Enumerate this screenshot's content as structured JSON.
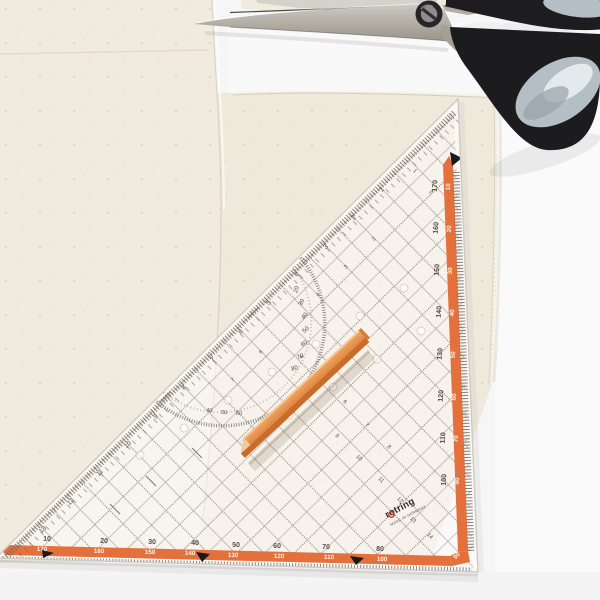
{
  "scene": {
    "description": "Flat-lay photo: transparent triangular tailor's ruler with orange scales on cream fabric, orange tailor's chalk stick on top, black scissors at top right"
  },
  "colors": {
    "accent_orange": "#e4713c",
    "stick_orange": "#e08a44",
    "handle_black": "#1c1c1e",
    "handle_grey_blue": "#b4bec5",
    "fabric_cream": "#efe9dc",
    "metal_grey": "#b2ada3",
    "print_grey": "#4f4942"
  },
  "ruler": {
    "brand": "rotring",
    "origin_text": "MADE IN GERMANY",
    "labels": [
      {
        "t": "10",
        "x": 47,
        "y": 541,
        "r": 1.5,
        "c": "n1"
      },
      {
        "t": "20",
        "x": 104,
        "y": 543,
        "r": 1.5,
        "c": "n1"
      },
      {
        "t": "30",
        "x": 152,
        "y": 544,
        "r": 1.5,
        "c": "n1"
      },
      {
        "t": "40",
        "x": 195,
        "y": 545,
        "r": 1.5,
        "c": "n1"
      },
      {
        "t": "50",
        "x": 236,
        "y": 547,
        "r": 1.5,
        "c": "n1"
      },
      {
        "t": "60",
        "x": 277,
        "y": 548,
        "r": 1.5,
        "c": "n1"
      },
      {
        "t": "70",
        "x": 326,
        "y": 549,
        "r": 1.5,
        "c": "n1"
      },
      {
        "t": "80",
        "x": 380,
        "y": 551,
        "r": 1.5,
        "c": "n1"
      },
      {
        "t": "170",
        "x": 42,
        "y": 551,
        "r": 1.5,
        "c": "n2"
      },
      {
        "t": "160",
        "x": 99,
        "y": 553,
        "r": 1.5,
        "c": "n2"
      },
      {
        "t": "150",
        "x": 150,
        "y": 554,
        "r": 1.5,
        "c": "n2"
      },
      {
        "t": "140",
        "x": 190,
        "y": 555,
        "r": 1.5,
        "c": "n2"
      },
      {
        "t": "130",
        "x": 233,
        "y": 557,
        "r": 1.5,
        "c": "n2"
      },
      {
        "t": "120",
        "x": 279,
        "y": 558,
        "r": 1.5,
        "c": "n2"
      },
      {
        "t": "110",
        "x": 329,
        "y": 559,
        "r": 1.5,
        "c": "n2"
      },
      {
        "t": "100",
        "x": 382,
        "y": 561,
        "r": 1.5,
        "c": "n2"
      },
      {
        "t": "90",
        "x": 458,
        "y": 557,
        "r": -45,
        "c": "n2"
      },
      {
        "t": "170",
        "x": 437,
        "y": 186,
        "r": -86,
        "c": "n1"
      },
      {
        "t": "160",
        "x": 438,
        "y": 228,
        "r": -86,
        "c": "n1"
      },
      {
        "t": "150",
        "x": 439,
        "y": 270,
        "r": -86,
        "c": "n1"
      },
      {
        "t": "140",
        "x": 441,
        "y": 312,
        "r": -86,
        "c": "n1"
      },
      {
        "t": "130",
        "x": 442,
        "y": 354,
        "r": -86,
        "c": "n1"
      },
      {
        "t": "120",
        "x": 443,
        "y": 396,
        "r": -86,
        "c": "n1"
      },
      {
        "t": "110",
        "x": 445,
        "y": 438,
        "r": -86,
        "c": "n1"
      },
      {
        "t": "100",
        "x": 446,
        "y": 480,
        "r": -86,
        "c": "n1"
      },
      {
        "t": "10",
        "x": 450,
        "y": 187,
        "r": -86,
        "c": "n2"
      },
      {
        "t": "20",
        "x": 451,
        "y": 229,
        "r": -86,
        "c": "n2"
      },
      {
        "t": "30",
        "x": 452,
        "y": 271,
        "r": -86,
        "c": "n2"
      },
      {
        "t": "40",
        "x": 454,
        "y": 313,
        "r": -86,
        "c": "n2"
      },
      {
        "t": "50",
        "x": 455,
        "y": 355,
        "r": -86,
        "c": "n2"
      },
      {
        "t": "60",
        "x": 456,
        "y": 397,
        "r": -86,
        "c": "n2"
      },
      {
        "t": "70",
        "x": 458,
        "y": 439,
        "r": -86,
        "c": "n2"
      },
      {
        "t": "80",
        "x": 459,
        "y": 481,
        "r": -86,
        "c": "n2"
      },
      {
        "t": "1",
        "x": 383,
        "y": 191,
        "r": -44,
        "c": "n3"
      },
      {
        "t": "2",
        "x": 355,
        "y": 219,
        "r": -44,
        "c": "n3"
      },
      {
        "t": "3",
        "x": 327,
        "y": 248,
        "r": -44,
        "c": "n3"
      },
      {
        "t": "4",
        "x": 298,
        "y": 276,
        "r": -44,
        "c": "n3"
      },
      {
        "t": "5",
        "x": 270,
        "y": 304,
        "r": -44,
        "c": "n3"
      },
      {
        "t": "6",
        "x": 242,
        "y": 333,
        "r": -44,
        "c": "n3"
      },
      {
        "t": "7",
        "x": 214,
        "y": 361,
        "r": -44,
        "c": "n3"
      },
      {
        "t": "8",
        "x": 185,
        "y": 389,
        "r": -44,
        "c": "n3"
      },
      {
        "t": "9",
        "x": 157,
        "y": 418,
        "r": -44,
        "c": "n3"
      },
      {
        "t": "10",
        "x": 129,
        "y": 446,
        "r": -44,
        "c": "n3"
      },
      {
        "t": "11",
        "x": 101,
        "y": 474,
        "r": -44,
        "c": "n3"
      },
      {
        "t": "12",
        "x": 72,
        "y": 503,
        "r": -44,
        "c": "n3"
      },
      {
        "t": "13",
        "x": 44,
        "y": 531,
        "r": -44,
        "c": "n3"
      },
      {
        "t": "2",
        "x": 375,
        "y": 240,
        "r": -44,
        "c": "n4"
      },
      {
        "t": "3",
        "x": 347,
        "y": 268,
        "r": -44,
        "c": "n4"
      },
      {
        "t": "4",
        "x": 319,
        "y": 296,
        "r": -44,
        "c": "n4"
      },
      {
        "t": "6",
        "x": 262,
        "y": 353,
        "r": -44,
        "c": "n4"
      },
      {
        "t": "7",
        "x": 234,
        "y": 381,
        "r": -44,
        "c": "n4"
      },
      {
        "t": "9",
        "x": 336,
        "y": 437,
        "r": 44,
        "c": "n4"
      },
      {
        "t": "10",
        "x": 358,
        "y": 459,
        "r": 44,
        "c": "n4"
      },
      {
        "t": "11",
        "x": 380,
        "y": 481,
        "r": 44,
        "c": "n4"
      },
      {
        "t": "12",
        "x": 399,
        "y": 501,
        "r": 44,
        "c": "n4"
      },
      {
        "t": "13",
        "x": 412,
        "y": 521,
        "r": 44,
        "c": "n4"
      },
      {
        "t": "14",
        "x": 429,
        "y": 537,
        "r": 44,
        "c": "n4"
      },
      {
        "t": "4",
        "x": 300,
        "y": 358,
        "r": 44,
        "c": "n4"
      },
      {
        "t": "5",
        "x": 322,
        "y": 381,
        "r": 44,
        "c": "n4"
      },
      {
        "t": "6",
        "x": 344,
        "y": 403,
        "r": 44,
        "c": "n4"
      },
      {
        "t": "7",
        "x": 366,
        "y": 426,
        "r": 44,
        "c": "n4"
      },
      {
        "t": "8",
        "x": 388,
        "y": 448,
        "r": 44,
        "c": "n4"
      },
      {
        "t": "1",
        "x": 414,
        "y": 172,
        "r": 44,
        "c": "n4"
      },
      {
        "t": "2",
        "x": 430,
        "y": 193,
        "r": 44,
        "c": "n4"
      },
      {
        "t": "20",
        "x": 298,
        "y": 290,
        "r": -73,
        "c": "deg"
      },
      {
        "t": "30",
        "x": 303,
        "y": 303,
        "r": -63,
        "c": "deg"
      },
      {
        "t": "40",
        "x": 306,
        "y": 317,
        "r": -53,
        "c": "deg"
      },
      {
        "t": "50",
        "x": 307,
        "y": 331,
        "r": -43,
        "c": "deg"
      },
      {
        "t": "60",
        "x": 305,
        "y": 345,
        "r": -33,
        "c": "deg"
      },
      {
        "t": "70",
        "x": 301,
        "y": 358,
        "r": -23,
        "c": "deg"
      },
      {
        "t": "80",
        "x": 295,
        "y": 370,
        "r": -13,
        "c": "deg"
      },
      {
        "t": "40",
        "x": 209,
        "y": 412,
        "r": 8,
        "c": "deg2"
      },
      {
        "t": "50",
        "x": 224,
        "y": 414,
        "r": 4,
        "c": "deg2"
      },
      {
        "t": "60",
        "x": 239,
        "y": 415,
        "r": 0,
        "c": "deg2"
      },
      {
        "t": "rotring",
        "x": 387,
        "y": 518,
        "r": -28,
        "c": "logo"
      },
      {
        "t": "MADE IN GERMANY",
        "x": 391,
        "y": 526,
        "r": -28,
        "c": "made"
      }
    ]
  }
}
